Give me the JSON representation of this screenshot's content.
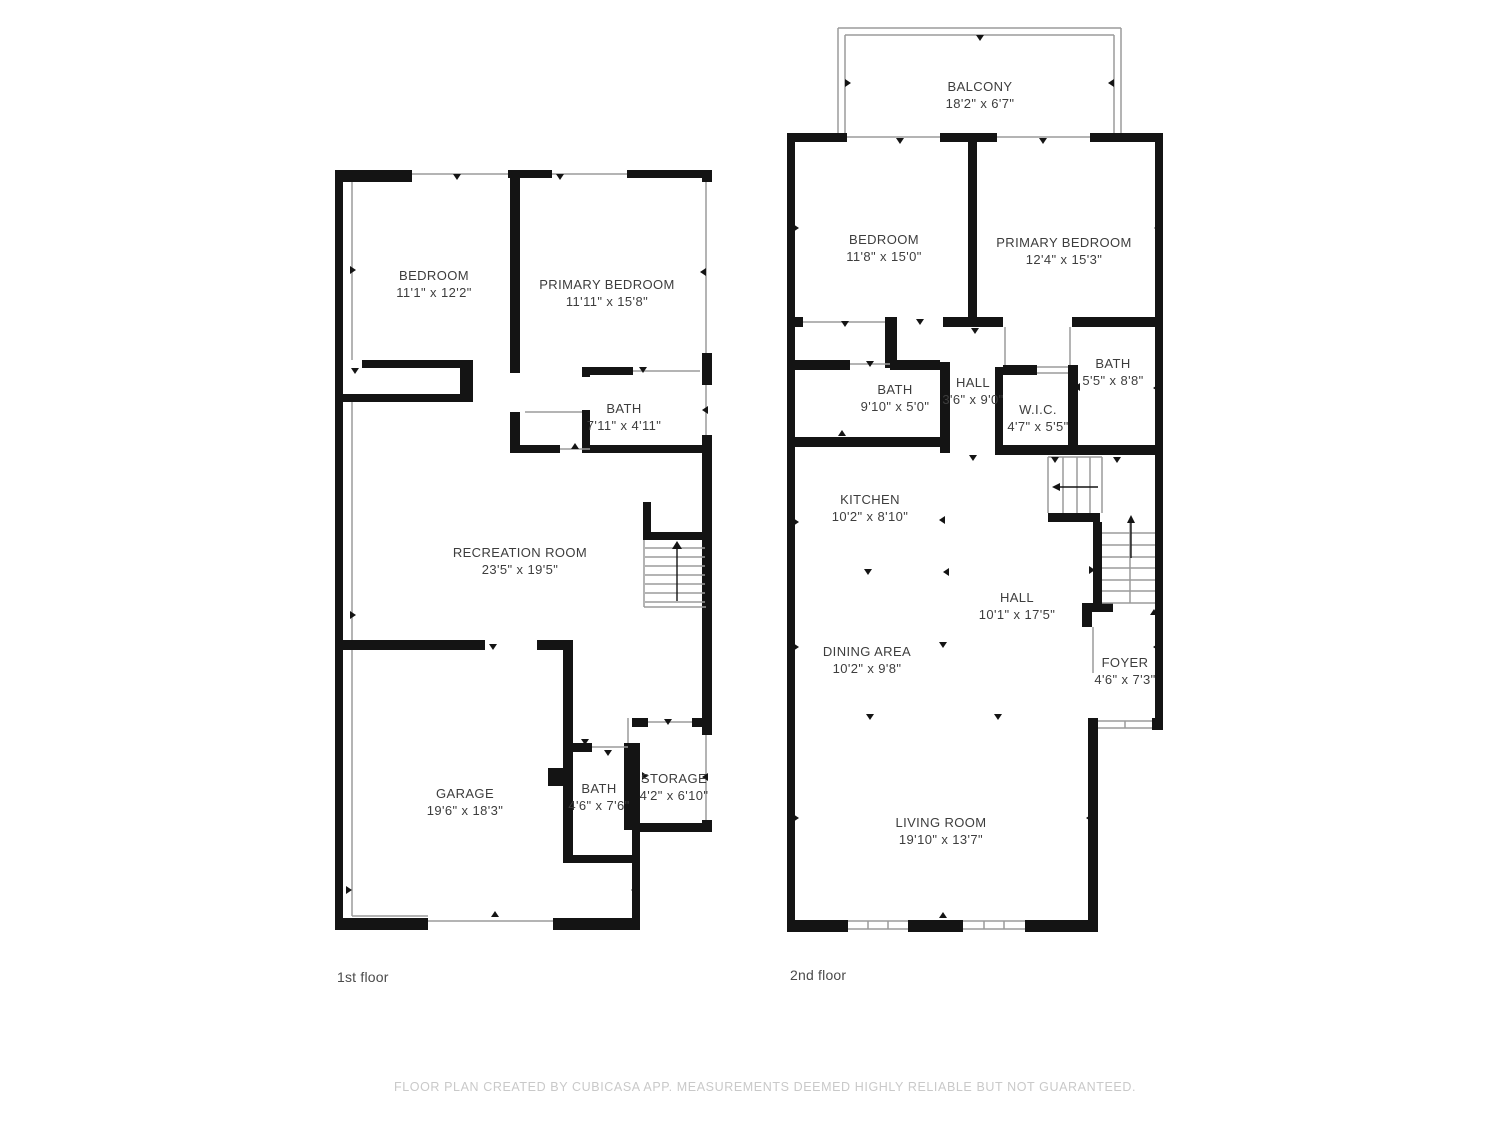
{
  "colors": {
    "background": "#ffffff",
    "wall": "#141414",
    "thin_line": "#9b9b9b",
    "room_label_text": "#3d3d3d",
    "floor_label_text": "#4a4a4a",
    "footer_text": "#c9c9c9"
  },
  "floors": [
    {
      "label": "1st floor",
      "rooms": [
        {
          "name": "BEDROOM",
          "dims": "11'1\" x 12'2\""
        },
        {
          "name": "PRIMARY BEDROOM",
          "dims": "11'11\" x 15'8\""
        },
        {
          "name": "BATH",
          "dims": "7'11\" x 4'11\""
        },
        {
          "name": "RECREATION ROOM",
          "dims": "23'5\" x 19'5\""
        },
        {
          "name": "GARAGE",
          "dims": "19'6\" x 18'3\""
        },
        {
          "name": "BATH",
          "dims": "4'6\" x 7'6\""
        },
        {
          "name": "STORAGE",
          "dims": "4'2\" x 6'10\""
        }
      ]
    },
    {
      "label": "2nd floor",
      "rooms": [
        {
          "name": "BALCONY",
          "dims": "18'2\" x 6'7\""
        },
        {
          "name": "BEDROOM",
          "dims": "11'8\" x 15'0\""
        },
        {
          "name": "PRIMARY BEDROOM",
          "dims": "12'4\" x 15'3\""
        },
        {
          "name": "BATH",
          "dims": "9'10\" x 5'0\""
        },
        {
          "name": "HALL",
          "dims": "3'6\" x 9'0\""
        },
        {
          "name": "W.I.C.",
          "dims": "4'7\" x 5'5\""
        },
        {
          "name": "BATH",
          "dims": "5'5\" x 8'8\""
        },
        {
          "name": "KITCHEN",
          "dims": "10'2\" x 8'10\""
        },
        {
          "name": "HALL",
          "dims": "10'1\" x 17'5\""
        },
        {
          "name": "DINING AREA",
          "dims": "10'2\" x 9'8\""
        },
        {
          "name": "FOYER",
          "dims": "4'6\" x 7'3\""
        },
        {
          "name": "LIVING ROOM",
          "dims": "19'10\" x 13'7\""
        }
      ]
    }
  ],
  "footer": {
    "disclaimer": "FLOOR PLAN CREATED BY CUBICASA APP. MEASUREMENTS DEEMED HIGHLY RELIABLE BUT NOT GUARANTEED."
  }
}
